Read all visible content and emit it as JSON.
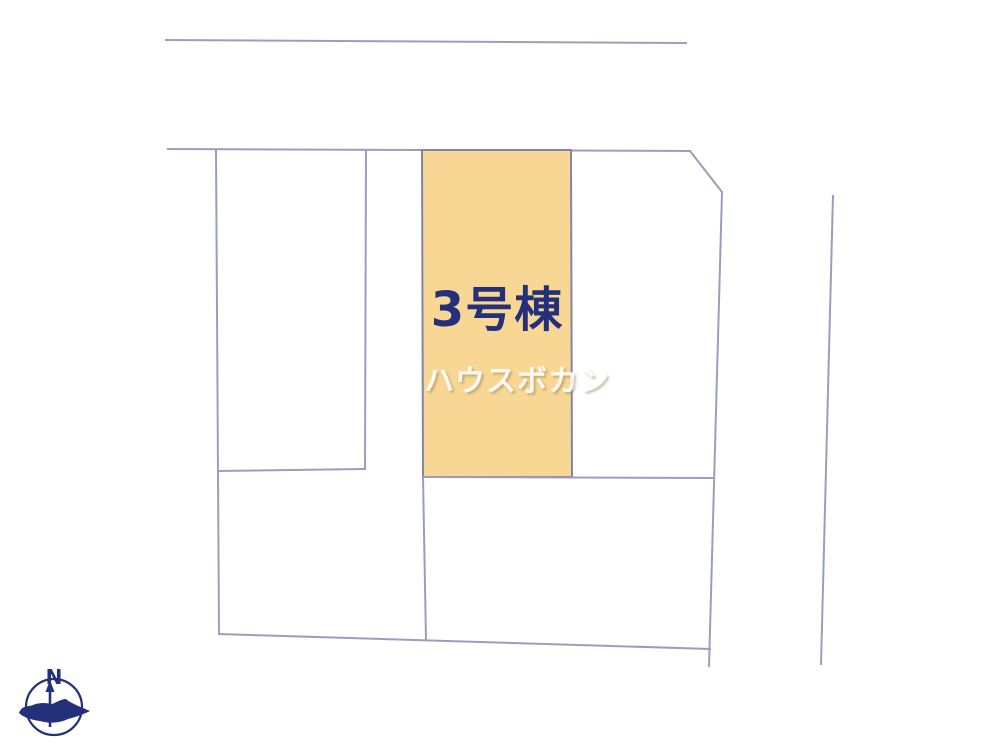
{
  "plan": {
    "lot_label": "3号棟",
    "watermark_text": "ハウスボカン"
  },
  "compass": {
    "north_label": "N"
  },
  "colors": {
    "background": "#FFFFFF",
    "boundary_line": "#9A9EBC",
    "lot_fill": "#F8D693",
    "lot_border": "#8185AC",
    "lot_label_text": "#25307B",
    "watermark_text": "#FFFFFF",
    "compass_navy": "#25307B"
  }
}
